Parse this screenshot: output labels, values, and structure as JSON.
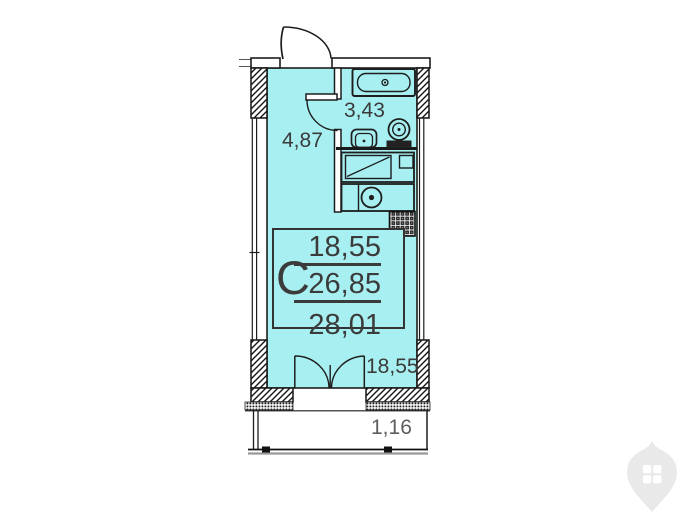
{
  "plan": {
    "title": "studio apartment floor plan",
    "unit_card": {
      "letter": "С",
      "living_area": "18,55",
      "total_area": "26,85",
      "total_with_balcony": "28,01"
    },
    "area_labels": [
      {
        "room": "bathroom",
        "text": "3,43"
      },
      {
        "room": "hall",
        "text": "4,87"
      },
      {
        "room": "living-room",
        "text": "18,55"
      },
      {
        "room": "balcony",
        "text": "1,16"
      }
    ],
    "fixtures": [
      "bathtub",
      "toilet",
      "washing-machine",
      "kitchen-counter",
      "kitchen-sink",
      "burner",
      "vent-shaft",
      "entrance-door",
      "bathroom-door",
      "balcony-french-door",
      "window-left",
      "window-right",
      "balcony"
    ],
    "colors": {
      "floor": "#a7eff1",
      "wall_line": "#1d1d1d",
      "label_text": "#3b3b3b",
      "balcony_text": "#5e5e5e",
      "watermark": "#e9e9e9"
    }
  }
}
